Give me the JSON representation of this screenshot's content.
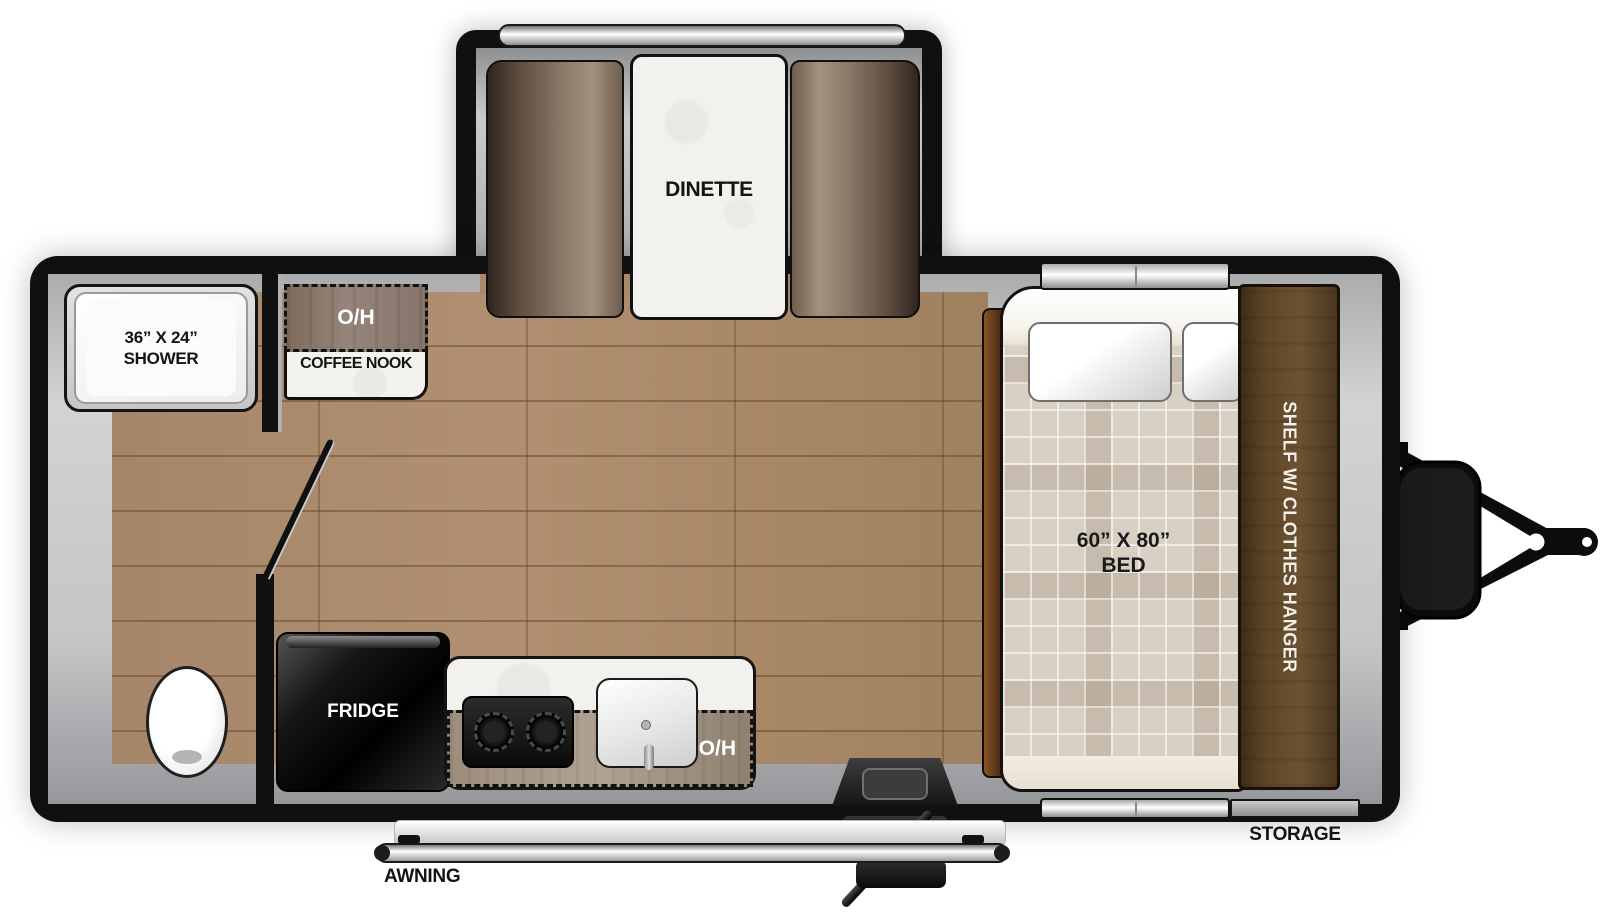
{
  "floorplan": {
    "slideout": {
      "dinette_label": "DINETTE"
    },
    "bathroom": {
      "shower_size": "36” X 24”",
      "shower_label": "SHOWER"
    },
    "coffee_nook": {
      "overhead_label": "O/H",
      "label": "COFFEE NOOK"
    },
    "kitchen": {
      "fridge_label": "FRIDGE",
      "overhead_label": "O/H"
    },
    "bedroom": {
      "bed_size": "60” X 80”",
      "bed_label": "BED",
      "shelf_label": "SHELF W/ CLOTHES HANGER"
    },
    "exterior": {
      "storage_label": "STORAGE",
      "awning_label": "AWNING"
    }
  },
  "colors": {
    "wall_black": "#101010",
    "wood_floor": "#a9896a",
    "trim_gray": "#c4c5c7",
    "cabinet_brown": "#5d4527",
    "counter_white": "#f3f1ed",
    "mattress_plaid": "#d9d0c4"
  }
}
